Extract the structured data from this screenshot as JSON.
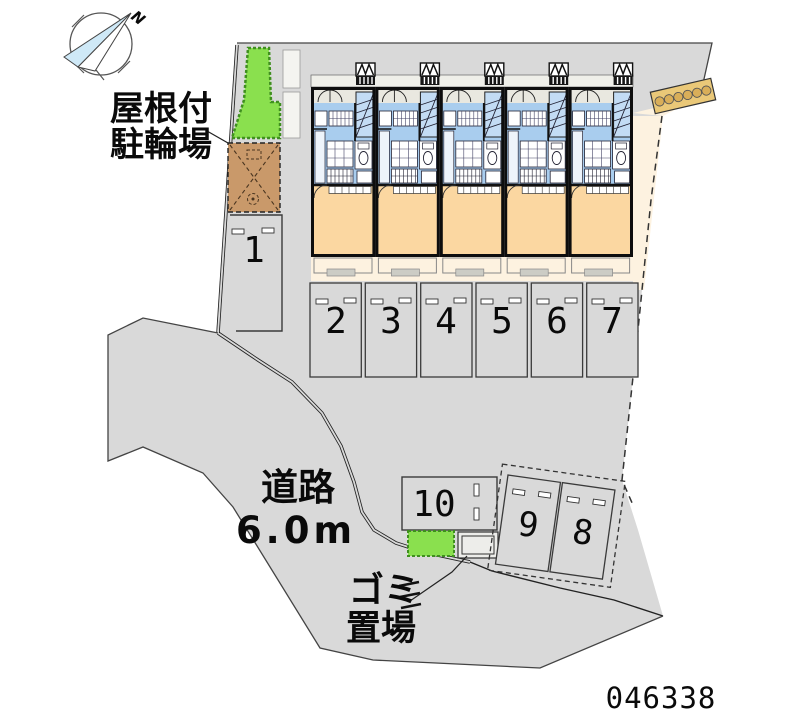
{
  "drawing_id": "046338",
  "compass": {
    "north_label": "N"
  },
  "annotations": {
    "bicycle_parking_line1": "屋根付",
    "bicycle_parking_line2": "駐輪場",
    "road_line1": "道路",
    "road_line2": "6.0m",
    "garbage_line1": "ゴミ",
    "garbage_line2": "置場"
  },
  "parking": {
    "stalls": [
      {
        "label": "1"
      },
      {
        "label": "2"
      },
      {
        "label": "3"
      },
      {
        "label": "4"
      },
      {
        "label": "5"
      },
      {
        "label": "6"
      },
      {
        "label": "7"
      },
      {
        "label": "8"
      },
      {
        "label": "9"
      },
      {
        "label": "10"
      }
    ]
  },
  "building": {
    "unit_count": 5
  },
  "colors": {
    "pavement_gray": "#d9d9d9",
    "site_cream": "#fdf2e0",
    "room_orange": "#fbd7a1",
    "plan_blue": "#a9cdee",
    "stair_blue": "#c3dcf4",
    "planting_green": "#8ae04e",
    "bicycle_area_brown": "#c9996a",
    "rack_tan": "#eac878",
    "compass_blue": "#cfe9f7",
    "wall_black": "#111111"
  }
}
